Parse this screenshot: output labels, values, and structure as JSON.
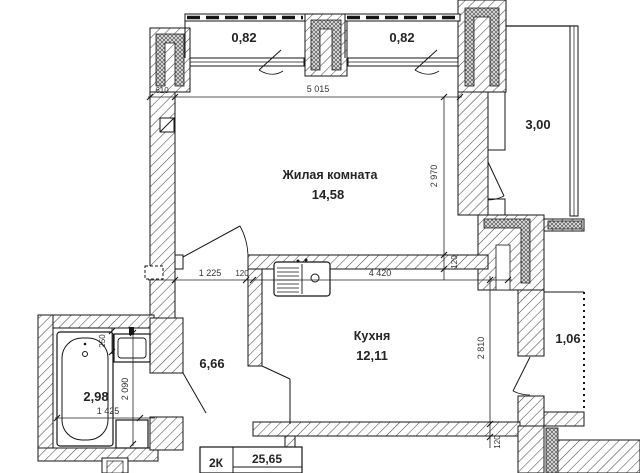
{
  "rooms": {
    "living": {
      "label": "Жилая комната",
      "area": "14,58"
    },
    "kitchen": {
      "label": "Кухня",
      "area": "12,11"
    },
    "hall": {
      "area": "6,66"
    },
    "bathroom": {
      "area": "2,98"
    },
    "loggia": {
      "area": "3,00"
    },
    "balcony_left": {
      "area": "0,82"
    },
    "balcony_right": {
      "area": "0,82"
    },
    "balcony_side": {
      "area": "1,06"
    }
  },
  "dimensions": {
    "offset_610": "610",
    "living_width": "5 015",
    "living_depth": "2 970",
    "wall_living": "120",
    "hall_width": "1 225",
    "wall_hall": "120",
    "kitchen_width": "4 420",
    "kitchen_depth": "2 810",
    "wall_kitchen": "120",
    "bathroom_depth": "2 090",
    "offset_250": "250",
    "bathroom_width": "1 425"
  },
  "stamp": {
    "apartment_type": "2К",
    "total_area": "25,65"
  },
  "colors": {
    "line": "#161616",
    "hatch": "#4a4a4a",
    "background": "#ffffff"
  }
}
